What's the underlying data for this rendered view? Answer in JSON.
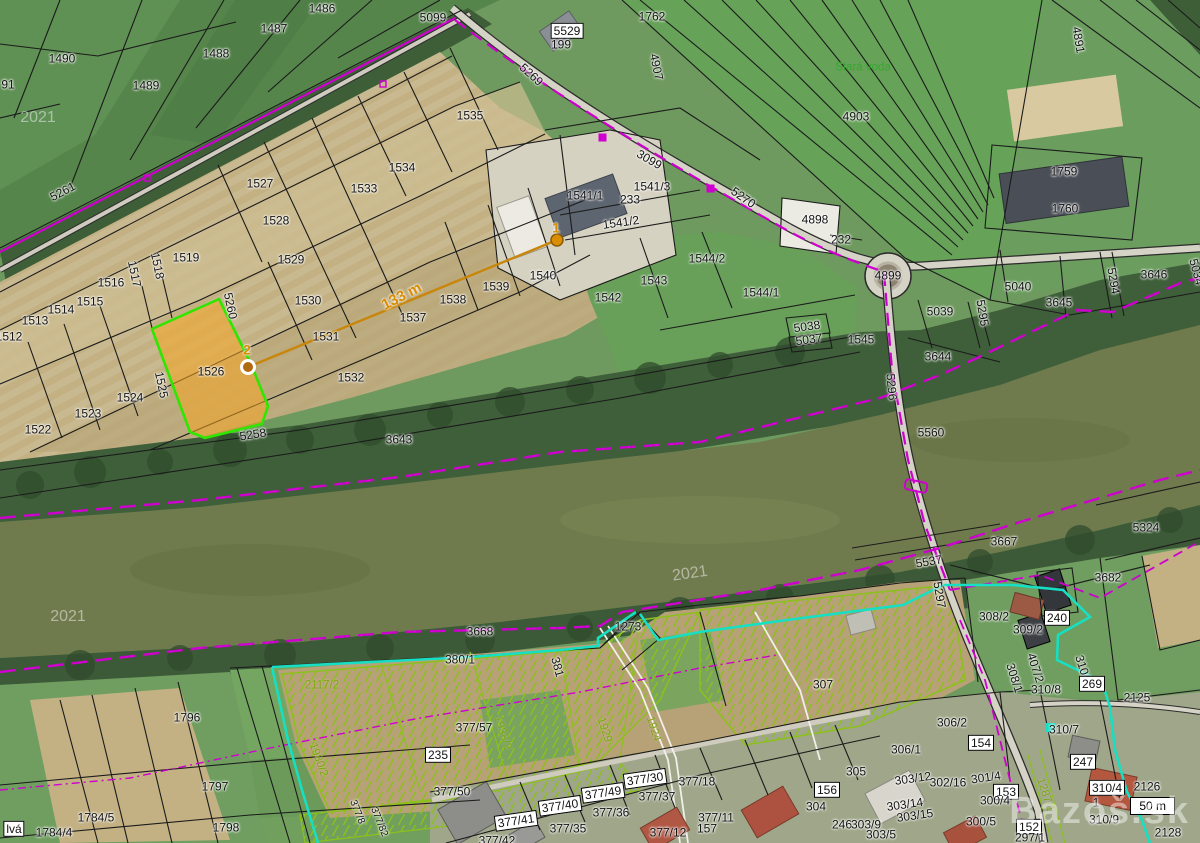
{
  "map": {
    "type": "cadastral-aerial-map",
    "scale_bar": "50 m",
    "watermark_site": "Bazoš.sk",
    "year_watermark": "2021",
    "selected_parcel": {
      "number": "1526",
      "fill": "#f5a623",
      "outline": "#2ee600"
    },
    "measurement": {
      "point_a": "1",
      "point_b": "2",
      "distance_label": "133 m",
      "line_color": "#c8860a"
    },
    "colors": {
      "boundary_black": "#1b1b1b",
      "utility_magenta": "#cf00cf",
      "zone_cyan": "#17dfc3",
      "garden_olive": "#8cc01c",
      "water": "#6f7b4d"
    },
    "labels": [
      {
        "t": "91",
        "x": 8,
        "y": 85
      },
      {
        "t": "1490",
        "x": 62,
        "y": 59
      },
      {
        "t": "1489",
        "x": 146,
        "y": 86
      },
      {
        "t": "1488",
        "x": 216,
        "y": 54
      },
      {
        "t": "1487",
        "x": 274,
        "y": 29
      },
      {
        "t": "1486",
        "x": 322,
        "y": 9
      },
      {
        "t": "2021",
        "x": 38,
        "y": 118,
        "k": "wm"
      },
      {
        "t": "5261",
        "x": 63,
        "y": 192,
        "r": -28
      },
      {
        "t": "5099",
        "x": 433,
        "y": 18
      },
      {
        "t": "5529",
        "x": 567,
        "y": 31,
        "k": "box"
      },
      {
        "t": "199",
        "x": 561,
        "y": 45
      },
      {
        "t": "1762",
        "x": 652,
        "y": 17
      },
      {
        "t": "4907",
        "x": 656,
        "y": 67,
        "r": 78
      },
      {
        "t": "5269",
        "x": 531,
        "y": 75,
        "r": 42
      },
      {
        "t": "3099",
        "x": 649,
        "y": 160,
        "r": 30
      },
      {
        "t": "5270",
        "x": 743,
        "y": 198,
        "r": 35
      },
      {
        "t": "1535",
        "x": 470,
        "y": 116
      },
      {
        "t": "1534",
        "x": 402,
        "y": 168
      },
      {
        "t": "1533",
        "x": 364,
        "y": 189
      },
      {
        "t": "1527",
        "x": 260,
        "y": 184
      },
      {
        "t": "1528",
        "x": 276,
        "y": 221
      },
      {
        "t": "1529",
        "x": 291,
        "y": 260
      },
      {
        "t": "1530",
        "x": 308,
        "y": 301
      },
      {
        "t": "1531",
        "x": 326,
        "y": 337
      },
      {
        "t": "1532",
        "x": 351,
        "y": 378
      },
      {
        "t": "1519",
        "x": 186,
        "y": 258
      },
      {
        "t": "1518",
        "x": 157,
        "y": 266,
        "r": 78
      },
      {
        "t": "1517",
        "x": 134,
        "y": 274,
        "r": 78
      },
      {
        "t": "1516",
        "x": 111,
        "y": 283
      },
      {
        "t": "1515",
        "x": 90,
        "y": 302
      },
      {
        "t": "1514",
        "x": 61,
        "y": 310
      },
      {
        "t": "1513",
        "x": 35,
        "y": 321
      },
      {
        "t": "1512",
        "x": 9,
        "y": 337
      },
      {
        "t": "1526",
        "x": 211,
        "y": 372
      },
      {
        "t": "1525",
        "x": 161,
        "y": 385,
        "r": 78
      },
      {
        "t": "1524",
        "x": 130,
        "y": 398
      },
      {
        "t": "1523",
        "x": 88,
        "y": 414
      },
      {
        "t": "1522",
        "x": 38,
        "y": 430
      },
      {
        "t": "5260",
        "x": 230,
        "y": 306,
        "r": 78
      },
      {
        "t": "5258",
        "x": 253,
        "y": 435,
        "r": -9
      },
      {
        "t": "2",
        "x": 247,
        "y": 350,
        "k": "orange"
      },
      {
        "t": "133 m",
        "x": 402,
        "y": 297,
        "r": -27,
        "k": "orange-lg"
      },
      {
        "t": "1",
        "x": 556,
        "y": 228,
        "k": "orange"
      },
      {
        "t": "1537",
        "x": 413,
        "y": 318
      },
      {
        "t": "1538",
        "x": 453,
        "y": 300
      },
      {
        "t": "1539",
        "x": 496,
        "y": 287
      },
      {
        "t": "1540",
        "x": 543,
        "y": 276
      },
      {
        "t": "1541/1",
        "x": 585,
        "y": 196
      },
      {
        "t": "233",
        "x": 630,
        "y": 200
      },
      {
        "t": "1541/3",
        "x": 652,
        "y": 187
      },
      {
        "t": "1541/2",
        "x": 621,
        "y": 223,
        "r": -8
      },
      {
        "t": "1542",
        "x": 608,
        "y": 298
      },
      {
        "t": "1543",
        "x": 654,
        "y": 281
      },
      {
        "t": "1544/2",
        "x": 707,
        "y": 259
      },
      {
        "t": "1544/1",
        "x": 761,
        "y": 293
      },
      {
        "t": "3643",
        "x": 399,
        "y": 440
      },
      {
        "t": "Stará voda",
        "x": 863,
        "y": 68,
        "k": "green"
      },
      {
        "t": "4903",
        "x": 856,
        "y": 117
      },
      {
        "t": "4891",
        "x": 1078,
        "y": 40,
        "r": 80
      },
      {
        "t": "1759",
        "x": 1064,
        "y": 172
      },
      {
        "t": "1760",
        "x": 1065,
        "y": 209
      },
      {
        "t": "4898",
        "x": 815,
        "y": 220
      },
      {
        "t": "232",
        "x": 841,
        "y": 240
      },
      {
        "t": "4899",
        "x": 888,
        "y": 276
      },
      {
        "t": "5040",
        "x": 1018,
        "y": 287
      },
      {
        "t": "3645",
        "x": 1059,
        "y": 303
      },
      {
        "t": "3646",
        "x": 1154,
        "y": 275
      },
      {
        "t": "5294",
        "x": 1113,
        "y": 281,
        "r": 80
      },
      {
        "t": "5034",
        "x": 1196,
        "y": 272,
        "r": 75
      },
      {
        "t": "5039",
        "x": 940,
        "y": 312
      },
      {
        "t": "5295",
        "x": 982,
        "y": 313,
        "r": 80
      },
      {
        "t": "5038",
        "x": 807,
        "y": 327,
        "r": -8
      },
      {
        "t": "5037",
        "x": 809,
        "y": 340,
        "r": -8
      },
      {
        "t": "1545",
        "x": 861,
        "y": 340
      },
      {
        "t": "3644",
        "x": 938,
        "y": 357
      },
      {
        "t": "5296",
        "x": 891,
        "y": 387,
        "r": 85
      },
      {
        "t": "5560",
        "x": 931,
        "y": 433
      },
      {
        "t": "5324",
        "x": 1146,
        "y": 528
      },
      {
        "t": "3667",
        "x": 1004,
        "y": 542
      },
      {
        "t": "3682",
        "x": 1108,
        "y": 578
      },
      {
        "t": "5537",
        "x": 929,
        "y": 562,
        "r": -10
      },
      {
        "t": "5297",
        "x": 939,
        "y": 595,
        "r": 80
      },
      {
        "t": "2021",
        "x": 68,
        "y": 617,
        "k": "wm"
      },
      {
        "t": "2021",
        "x": 690,
        "y": 574,
        "k": "wm",
        "r": -8
      },
      {
        "t": "3668",
        "x": 480,
        "y": 632
      },
      {
        "t": "1273",
        "x": 628,
        "y": 627
      },
      {
        "t": "380/1",
        "x": 460,
        "y": 660
      },
      {
        "t": "381",
        "x": 557,
        "y": 667,
        "r": 75
      },
      {
        "t": "2117/2",
        "x": 322,
        "y": 686,
        "k": "olive"
      },
      {
        "t": "1796",
        "x": 187,
        "y": 718
      },
      {
        "t": "1797",
        "x": 215,
        "y": 787
      },
      {
        "t": "1798",
        "x": 226,
        "y": 828
      },
      {
        "t": "1784/5",
        "x": 96,
        "y": 818
      },
      {
        "t": "1784/4",
        "x": 54,
        "y": 833
      },
      {
        "t": "lvá",
        "x": 14,
        "y": 829,
        "k": "box"
      },
      {
        "t": "1938/2",
        "x": 502,
        "y": 733,
        "r": 72,
        "k": "olive"
      },
      {
        "t": "1929",
        "x": 604,
        "y": 730,
        "r": 72,
        "k": "olive"
      },
      {
        "t": "1924",
        "x": 653,
        "y": 729,
        "r": 72,
        "k": "olive"
      },
      {
        "t": "1980/2",
        "x": 318,
        "y": 760,
        "r": 70,
        "k": "olive"
      },
      {
        "t": "377/57",
        "x": 474,
        "y": 728
      },
      {
        "t": "235",
        "x": 438,
        "y": 755,
        "k": "box"
      },
      {
        "t": "377/50",
        "x": 452,
        "y": 792
      },
      {
        "t": "377/8",
        "x": 357,
        "y": 812,
        "r": 68,
        "k": "tiny"
      },
      {
        "t": "377/82",
        "x": 379,
        "y": 822,
        "r": 68,
        "k": "tiny"
      },
      {
        "t": "377/41",
        "x": 516,
        "y": 821,
        "k": "box",
        "r": -8
      },
      {
        "t": "377/40",
        "x": 560,
        "y": 806,
        "k": "box",
        "r": -8
      },
      {
        "t": "377/49",
        "x": 603,
        "y": 793,
        "k": "box",
        "r": -8
      },
      {
        "t": "377/30",
        "x": 645,
        "y": 779,
        "k": "box",
        "r": -8
      },
      {
        "t": "377/36",
        "x": 611,
        "y": 813
      },
      {
        "t": "377/37",
        "x": 657,
        "y": 797
      },
      {
        "t": "377/18",
        "x": 697,
        "y": 782
      },
      {
        "t": "377/35",
        "x": 568,
        "y": 829
      },
      {
        "t": "377/42",
        "x": 497,
        "y": 841
      },
      {
        "t": "377/11",
        "x": 716,
        "y": 818
      },
      {
        "t": "157",
        "x": 707,
        "y": 829
      },
      {
        "t": "377/12",
        "x": 668,
        "y": 833
      },
      {
        "t": "307",
        "x": 823,
        "y": 685
      },
      {
        "t": "306/2",
        "x": 952,
        "y": 723
      },
      {
        "t": "306/1",
        "x": 906,
        "y": 750
      },
      {
        "t": "305",
        "x": 856,
        "y": 772
      },
      {
        "t": "156",
        "x": 827,
        "y": 790,
        "k": "box"
      },
      {
        "t": "304",
        "x": 816,
        "y": 807
      },
      {
        "t": "246",
        "x": 842,
        "y": 825
      },
      {
        "t": "303/9",
        "x": 866,
        "y": 825
      },
      {
        "t": "303/5",
        "x": 881,
        "y": 835
      },
      {
        "t": "303/12",
        "x": 913,
        "y": 779,
        "r": -8
      },
      {
        "t": "302/16",
        "x": 948,
        "y": 783
      },
      {
        "t": "303/14",
        "x": 905,
        "y": 805,
        "r": -8
      },
      {
        "t": "303/15",
        "x": 915,
        "y": 816,
        "r": -8
      },
      {
        "t": "301/4",
        "x": 986,
        "y": 778,
        "r": -8
      },
      {
        "t": "154",
        "x": 981,
        "y": 743,
        "k": "box"
      },
      {
        "t": "153",
        "x": 1006,
        "y": 792,
        "k": "box"
      },
      {
        "t": "300/4",
        "x": 995,
        "y": 801
      },
      {
        "t": "300/5",
        "x": 981,
        "y": 822
      },
      {
        "t": "152",
        "x": 1029,
        "y": 827,
        "k": "box"
      },
      {
        "t": "297/1",
        "x": 1030,
        "y": 838
      },
      {
        "t": "308/1",
        "x": 1014,
        "y": 678,
        "r": 72
      },
      {
        "t": "407/2",
        "x": 1035,
        "y": 668,
        "r": 72
      },
      {
        "t": "308/2",
        "x": 994,
        "y": 617
      },
      {
        "t": "309/2",
        "x": 1028,
        "y": 630
      },
      {
        "t": "240",
        "x": 1057,
        "y": 618,
        "k": "box"
      },
      {
        "t": "310/9",
        "x": 1083,
        "y": 670,
        "r": 72
      },
      {
        "t": "269",
        "x": 1092,
        "y": 684,
        "k": "box"
      },
      {
        "t": "2125",
        "x": 1137,
        "y": 698
      },
      {
        "t": "310/8",
        "x": 1046,
        "y": 690
      },
      {
        "t": "310/7",
        "x": 1064,
        "y": 730
      },
      {
        "t": "247",
        "x": 1083,
        "y": 762,
        "k": "box"
      },
      {
        "t": "310/4",
        "x": 1107,
        "y": 788,
        "k": "box"
      },
      {
        "t": "1",
        "x": 1096,
        "y": 803
      },
      {
        "t": "310/9",
        "x": 1104,
        "y": 820
      },
      {
        "t": "2126",
        "x": 1147,
        "y": 787
      },
      {
        "t": "2128",
        "x": 1168,
        "y": 833
      },
      {
        "t": "1287/1",
        "x": 1045,
        "y": 795,
        "r": 72,
        "k": "olive"
      }
    ]
  }
}
